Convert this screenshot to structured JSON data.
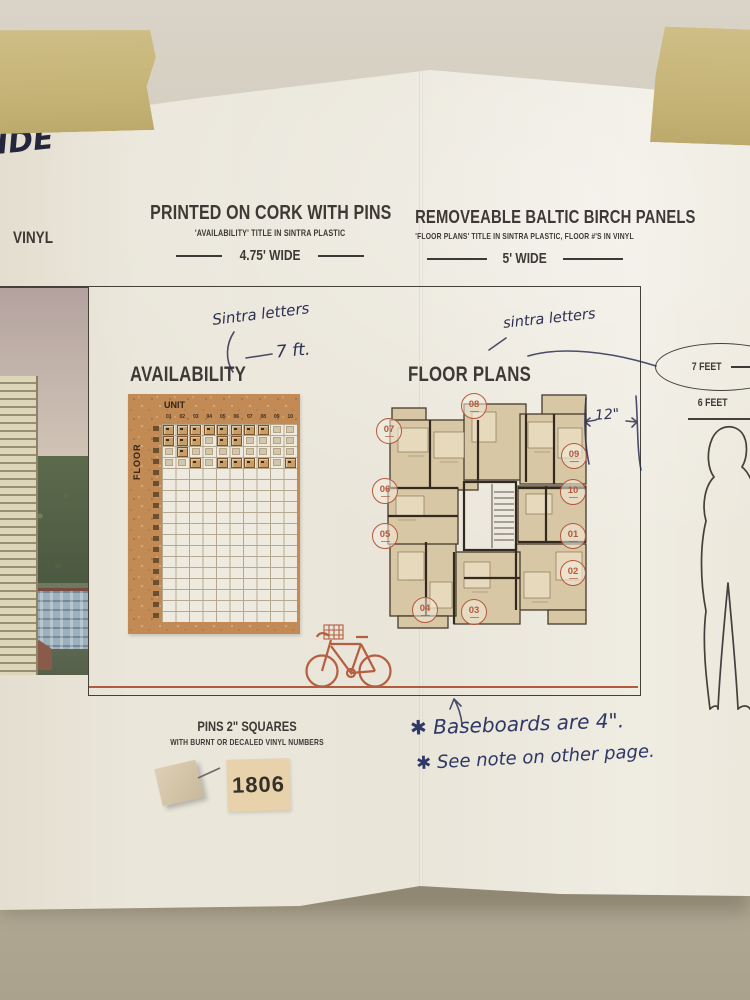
{
  "handwriting": {
    "top_left": "IDE",
    "availability_material": "Sintra letters",
    "availability_height": "7 ft.",
    "floorplans_material": "sintra letters",
    "panel_width": "12\"",
    "baseboard_note": "✱ Baseboards are 4\".",
    "see_note": "✱ See note on other page."
  },
  "left_panel": {
    "label": "VINYL"
  },
  "availability_section": {
    "header": "PRINTED ON CORK WITH PINS",
    "subheader": "'AVAILABILITY' TITLE IN SINTRA PLASTIC",
    "width": "4.75' WIDE",
    "title": "AVAILABILITY",
    "board": {
      "unit_axis_label": "UNIT",
      "floor_axis_label": "FLOOR",
      "unit_numbers": [
        "01",
        "02",
        "03",
        "04",
        "05",
        "06",
        "07",
        "08",
        "09",
        "10"
      ],
      "floor_row_count": 18,
      "pin_matrix": [
        [
          2,
          2,
          2,
          2,
          2,
          2,
          2,
          2,
          1,
          1
        ],
        [
          2,
          2,
          2,
          1,
          2,
          2,
          1,
          1,
          1,
          1
        ],
        [
          1,
          2,
          1,
          1,
          1,
          1,
          1,
          1,
          1,
          1
        ],
        [
          1,
          1,
          2,
          1,
          2,
          2,
          2,
          2,
          1,
          2
        ]
      ]
    }
  },
  "floorplans_section": {
    "header": "REMOVEABLE BALTIC BIRCH PANELS",
    "subheader": "'FLOOR PLANS' TITLE IN SINTRA PLASTIC, FLOOR #'S IN VINYL",
    "width": "5' WIDE",
    "title": "FLOOR PLANS",
    "unit_badges": [
      "08",
      "07",
      "09",
      "06",
      "10",
      "05",
      "01",
      "02",
      "04",
      "03"
    ]
  },
  "scale": {
    "seven_feet": "7 FEET",
    "six_feet": "6 FEET"
  },
  "pins_legend": {
    "line1": "PINS 2\" SQUARES",
    "line2": "WITH BURNT OR DECALED VINYL NUMBERS",
    "sample_number": "1806"
  },
  "colors": {
    "accent_orange": "#b55e41",
    "ink_navy": "#2d3152",
    "print_black": "#3e3935",
    "cork": "#c28a55",
    "tape": "#c6b478",
    "wall": "#c2bba9",
    "paper": "#eae6da"
  }
}
